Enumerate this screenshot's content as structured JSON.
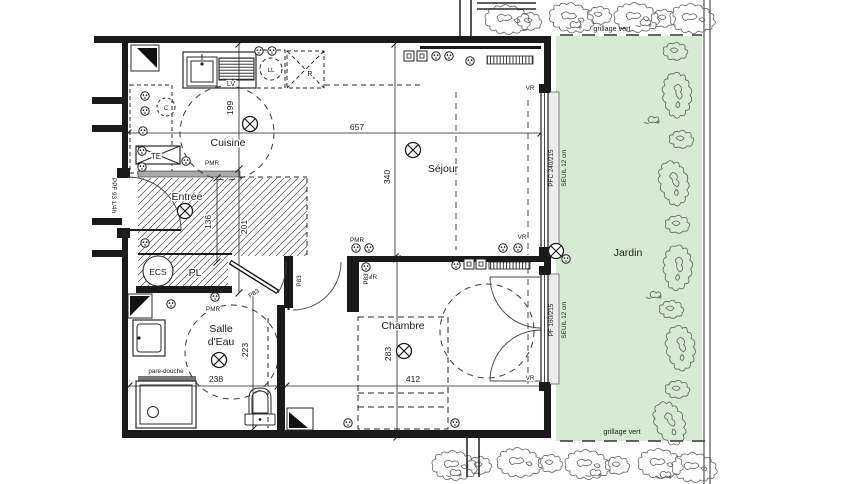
{
  "colors": {
    "garden": "#d7ead3",
    "wall": "#1a1a1a"
  },
  "site": {
    "fence_label": "grillage vert",
    "garden": "Jardin"
  },
  "rooms": {
    "kitchen": "Cuisine",
    "entry": "Entrée",
    "living": "Séjour",
    "bedroom": "Chambre",
    "bath_line1": "Salle",
    "bath_line2": "d'Eau"
  },
  "dimensions": {
    "living_width": "657",
    "living_depth": "340",
    "kitchen_depth": "199",
    "hall_depth": "201",
    "entry_width": "136",
    "bath_depth": "223",
    "bath_width": "238",
    "bedroom_depth": "283",
    "bedroom_width": "412"
  },
  "openings": {
    "entry_door": "PPF 93 1/4h",
    "interior_door": "P83",
    "window_living": "PFC 240/215",
    "window_bedroom": "PF 160/215",
    "sill": "SEUIL 12 cm",
    "shutter": "VR"
  },
  "equipment": {
    "electrical_panel": "TE",
    "dishwasher": "LV",
    "washer": "LL",
    "fridge": "R",
    "cooktop": "C",
    "water_heater": "ECS",
    "closet": "PL",
    "shower_screen": "pare-douche",
    "accessibility": "PMR"
  }
}
